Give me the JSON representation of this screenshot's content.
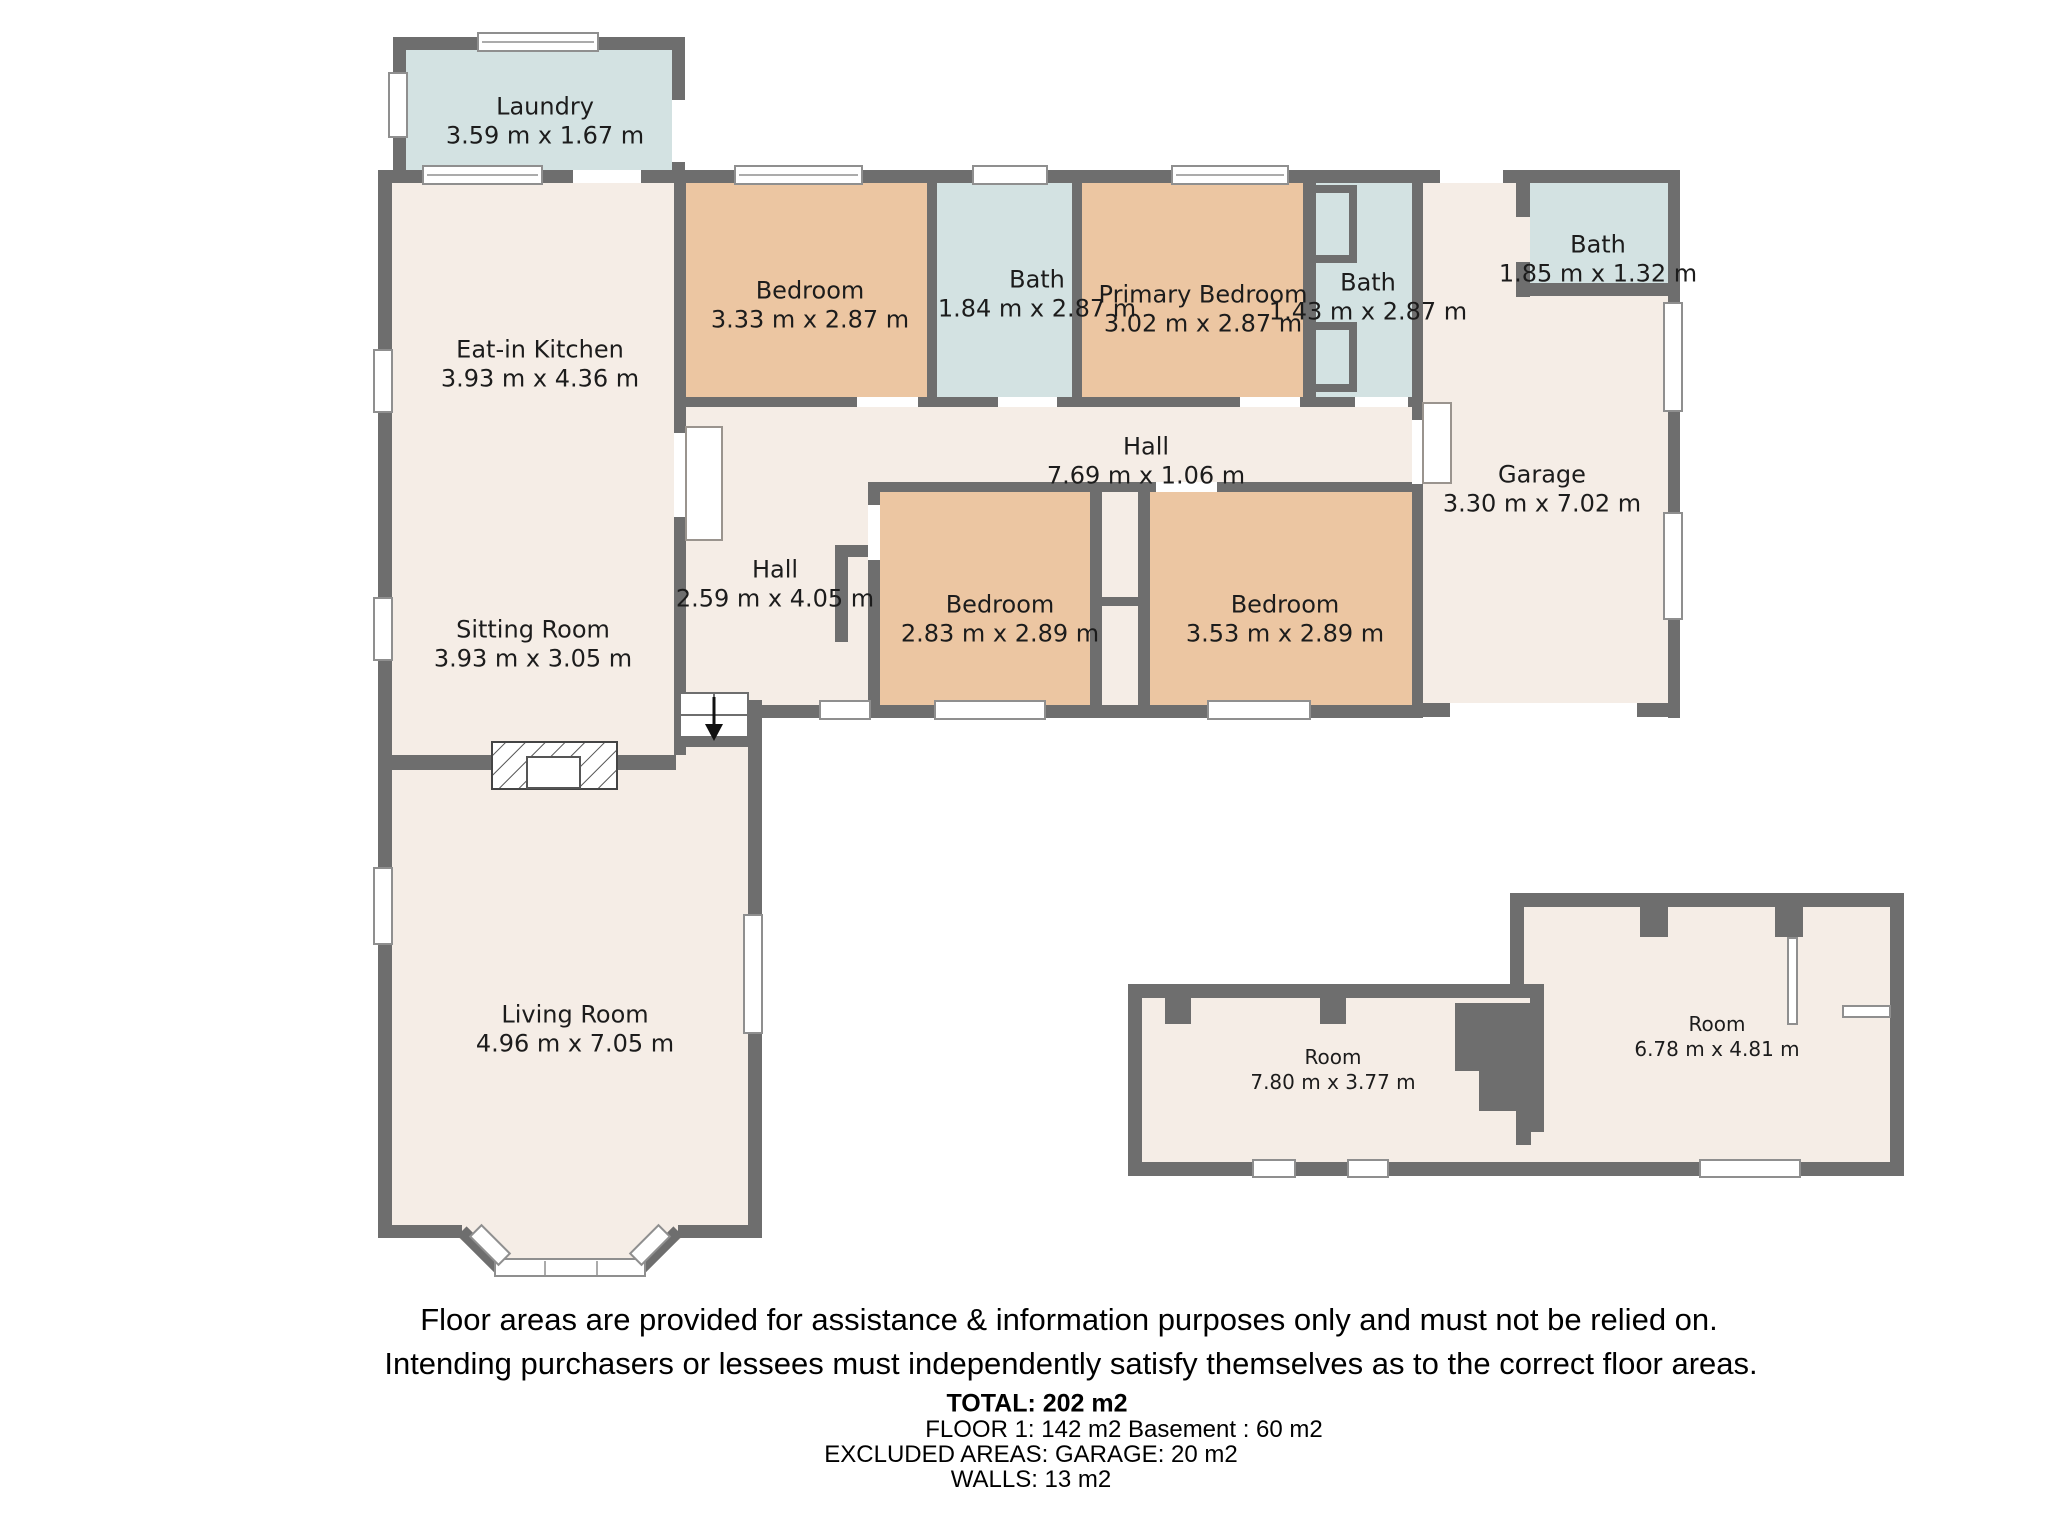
{
  "floorplan": {
    "colors": {
      "wall": "#6e6e6e",
      "floor_cream": "#f5ede6",
      "bedroom_tan": "#ecc6a2",
      "bath_blue": "#d3e2e2",
      "window_white": "#ffffff",
      "text": "#1c1c1c"
    },
    "rooms": [
      {
        "name": "Laundry",
        "dims": "3.59 m x 1.67 m"
      },
      {
        "name": "Eat-in Kitchen",
        "dims": "3.93 m x 4.36 m"
      },
      {
        "name": "Bedroom",
        "dims": "3.33 m x 2.87 m"
      },
      {
        "name": "Bath",
        "dims": "1.84 m x 2.87 m"
      },
      {
        "name": "Primary Bedroom",
        "dims": "3.02 m x 2.87 m"
      },
      {
        "name": "Bath",
        "dims": "1.43 m x 2.87 m"
      },
      {
        "name": "Bath",
        "dims": "1.85 m x 1.32 m"
      },
      {
        "name": "Hall",
        "dims": "7.69 m x 1.06 m"
      },
      {
        "name": "Garage",
        "dims": "3.30 m x 7.02 m"
      },
      {
        "name": "Hall",
        "dims": "2.59 m x 4.05 m"
      },
      {
        "name": "Bedroom",
        "dims": "2.83 m x 2.89 m"
      },
      {
        "name": "Bedroom",
        "dims": "3.53 m x 2.89 m"
      },
      {
        "name": "Sitting Room",
        "dims": "3.93 m x 3.05 m"
      },
      {
        "name": "Living Room",
        "dims": "4.96 m x 7.05 m"
      },
      {
        "name": "Room",
        "dims": "7.80 m x 3.77 m"
      },
      {
        "name": "Room",
        "dims": "6.78 m x 4.81 m"
      }
    ],
    "footer": {
      "disclaimer_line1": "Floor areas are provided for assistance & information purposes only and must not be relied on.",
      "disclaimer_line2": "Intending purchasers or lessees must independently satisfy themselves as to the correct floor areas.",
      "total": "TOTAL: 202 m2",
      "floors": "FLOOR 1: 142 m2 Basement : 60 m2",
      "excluded": "EXCLUDED AREAS: GARAGE: 20 m2",
      "walls": "WALLS: 13 m2"
    }
  }
}
